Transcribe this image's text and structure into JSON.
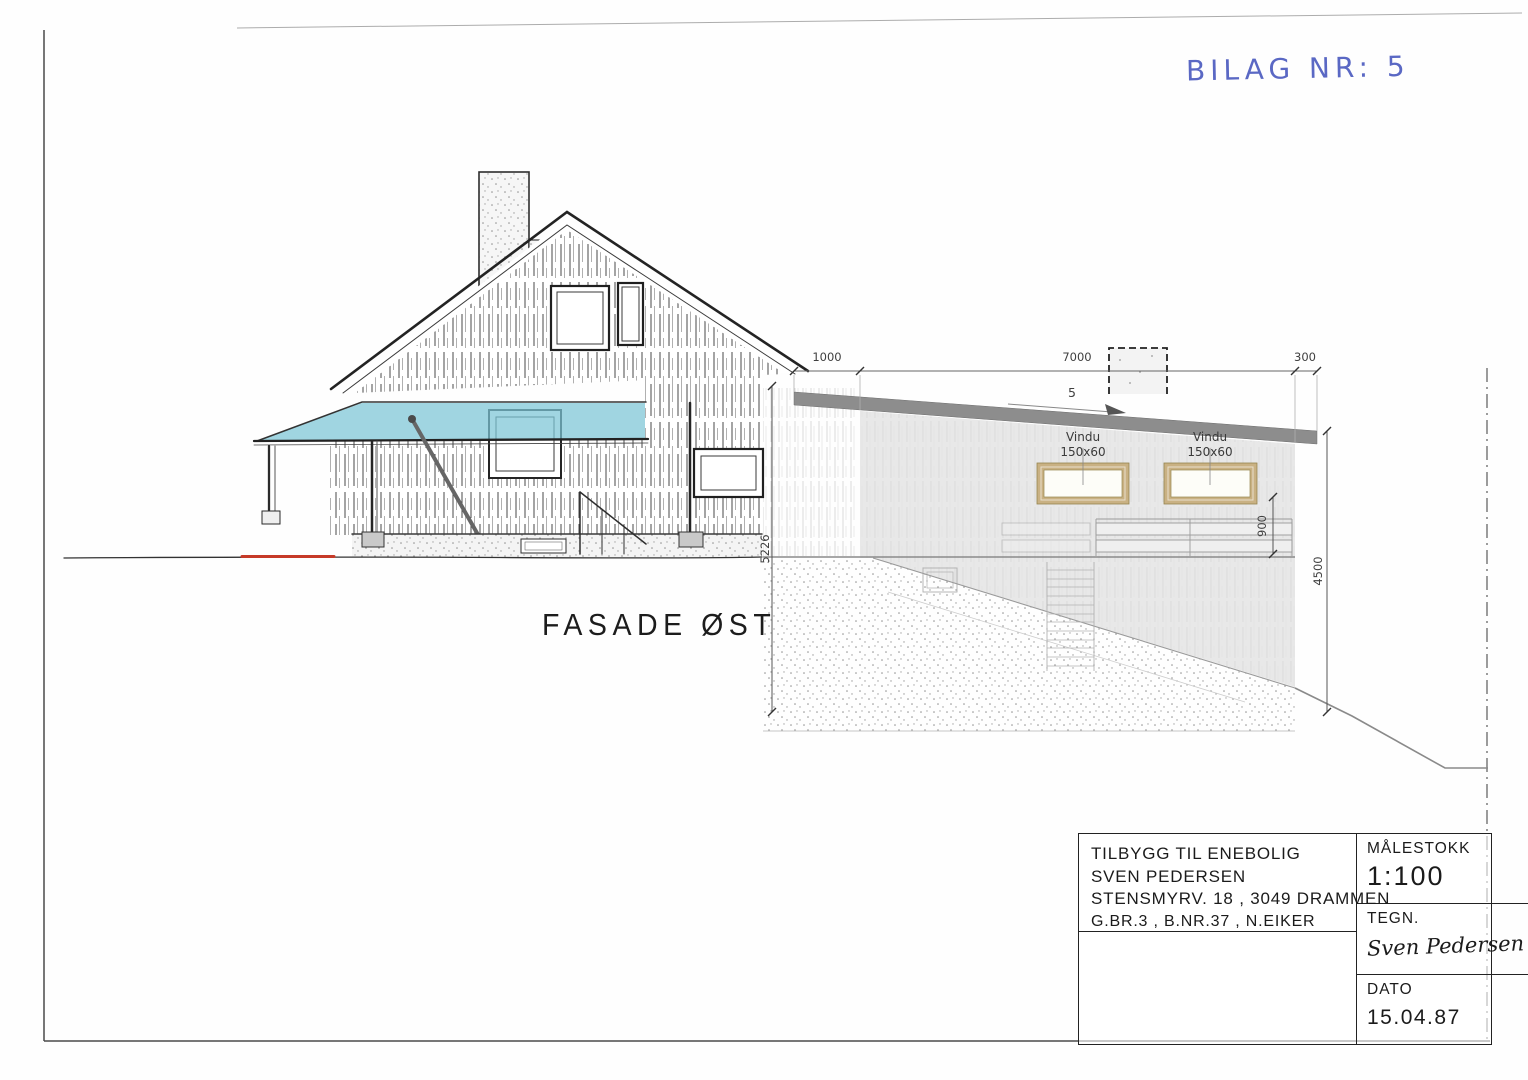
{
  "annotations": {
    "bilag": "BILAG NR: 5"
  },
  "drawing": {
    "facade_label": "FASADE ØST",
    "slope_label": "5",
    "window_labels": [
      {
        "name": "Vindu",
        "size": "150x60"
      },
      {
        "name": "Vindu",
        "size": "150x60"
      }
    ],
    "dimensions": {
      "top_left": "1000",
      "top_middle": "7000",
      "top_right": "300",
      "left_height": "5226",
      "right_height": "4500",
      "sill_height": "900"
    }
  },
  "title_block": {
    "line1": "TILBYGG TIL ENEBOLIG",
    "line2": "SVEN PEDERSEN",
    "line3": "STENSMYRV. 18 , 3049 DRAMMEN",
    "line4": "G.BR.3 , B.NR.37 , N.EIKER",
    "scale_label": "MÅLESTOKK",
    "scale_value": "1:100",
    "drawn_label": "TEGN.",
    "drawn_by": "Sven Pedersen",
    "date_label": "DATO",
    "date_value": "15.04.87"
  },
  "colors": {
    "awning_blue": "#7cc5d6",
    "roof_gray": "#8d8d8d",
    "window_frame_tan": "#c9b183",
    "glass_white": "#fdfdf8",
    "ground_red": "#c63a28",
    "handwriting_blue": "#5a68c4"
  }
}
